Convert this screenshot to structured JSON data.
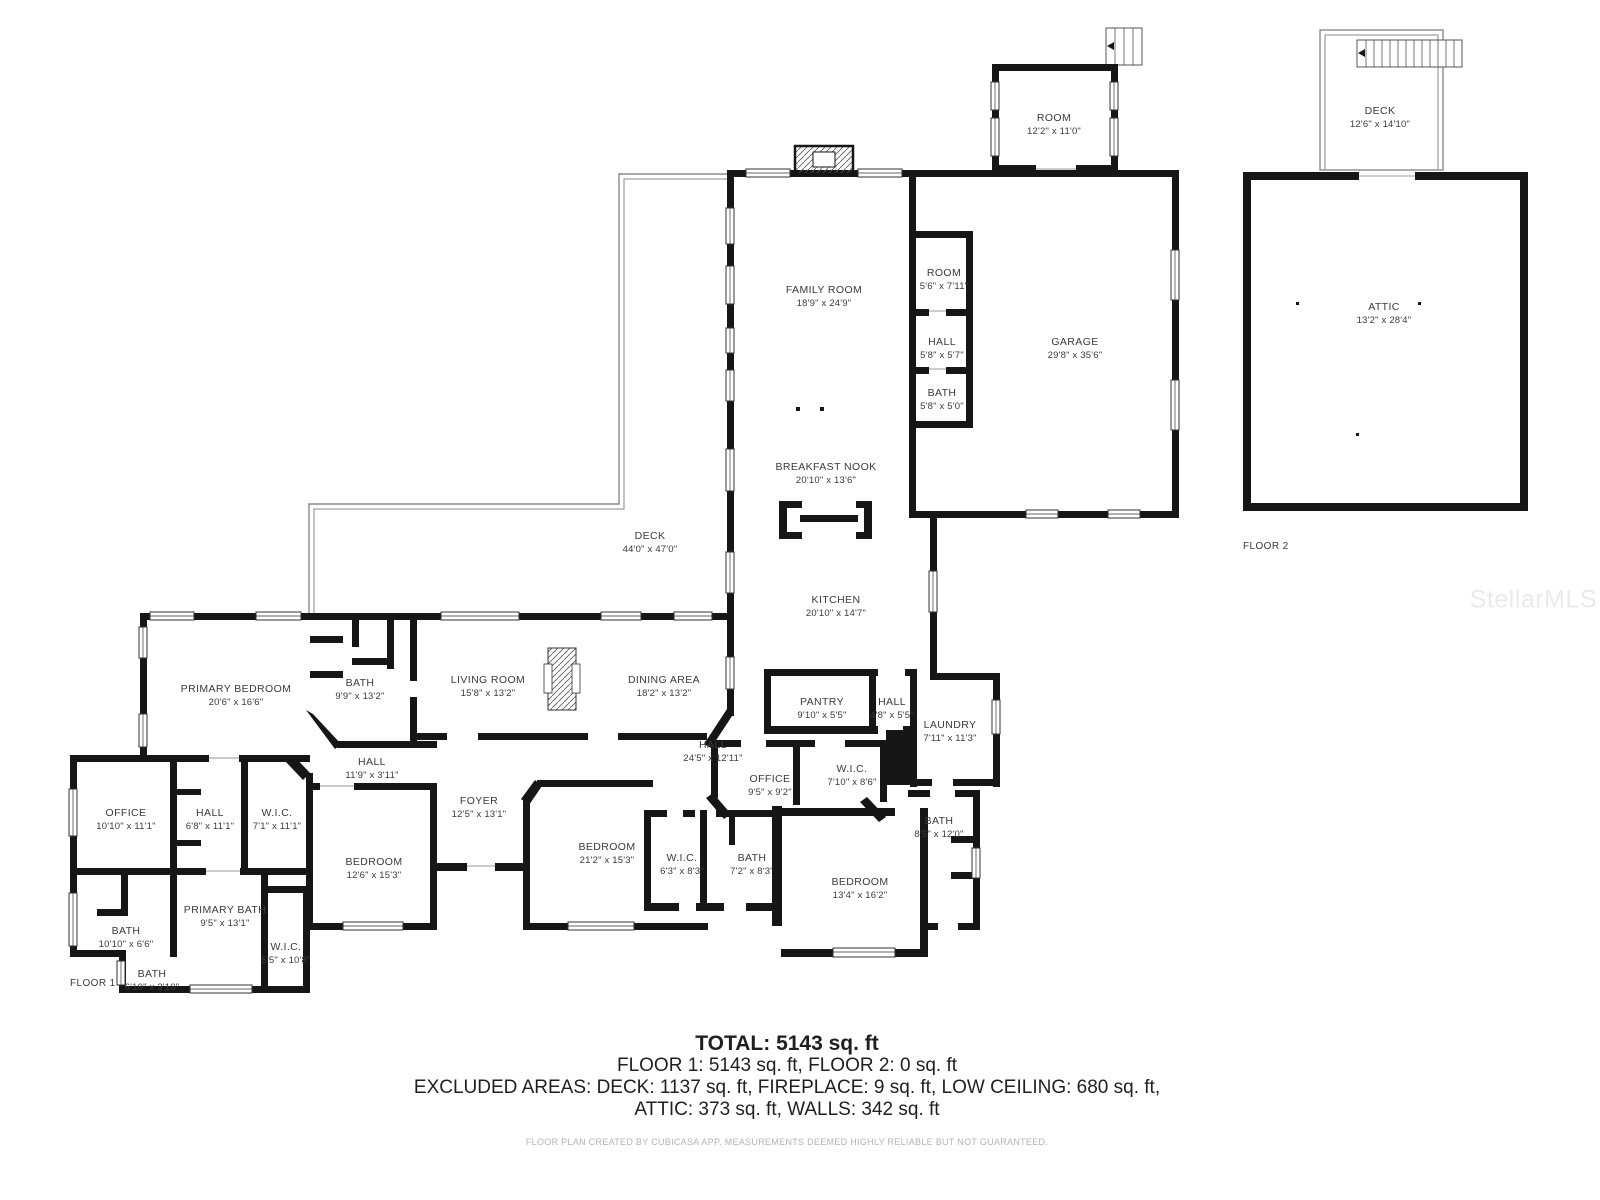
{
  "watermark": "StellarMLS",
  "floor_labels": {
    "floor1": "FLOOR 1",
    "floor2": "FLOOR 2"
  },
  "summary": {
    "total": "TOTAL: 5143 sq. ft",
    "floors": "FLOOR 1: 5143 sq. ft, FLOOR 2: 0 sq. ft",
    "excluded1": "EXCLUDED AREAS: DECK: 1137 sq. ft, FIREPLACE: 9 sq. ft, LOW CEILING: 680 sq. ft,",
    "excluded2": "ATTIC: 373 sq. ft, WALLS: 342 sq. ft",
    "credit": "FLOOR PLAN CREATED BY CUBICASA APP. MEASUREMENTS DEEMED HIGHLY RELIABLE BUT NOT GUARANTEED."
  },
  "colors": {
    "walls": "#161616",
    "room_text": "#3a3a3a",
    "credit_text": "#b3b3b3"
  },
  "rooms": [
    {
      "id": "room-upper",
      "name": "ROOM",
      "dims": "12'2\" x 11'0\""
    },
    {
      "id": "deck-upper",
      "name": "DECK",
      "dims": "12'6\" x 14'10\""
    },
    {
      "id": "family-room",
      "name": "FAMILY ROOM",
      "dims": "18'9\" x 24'9\""
    },
    {
      "id": "room-small",
      "name": "ROOM",
      "dims": "5'6\" x 7'11\""
    },
    {
      "id": "hall-small",
      "name": "HALL",
      "dims": "5'8\" x 5'7\""
    },
    {
      "id": "bath-small",
      "name": "BATH",
      "dims": "5'8\" x 5'0\""
    },
    {
      "id": "garage",
      "name": "GARAGE",
      "dims": "29'8\" x 35'6\""
    },
    {
      "id": "attic",
      "name": "ATTIC",
      "dims": "13'2\" x 28'4\""
    },
    {
      "id": "breakfast-nook",
      "name": "BREAKFAST NOOK",
      "dims": "20'10\" x 13'6\""
    },
    {
      "id": "deck-main",
      "name": "DECK",
      "dims": "44'0\" x 47'0\""
    },
    {
      "id": "kitchen",
      "name": "KITCHEN",
      "dims": "20'10\" x 14'7\""
    },
    {
      "id": "primary-bedroom",
      "name": "PRIMARY BEDROOM",
      "dims": "20'6\" x 16'6\""
    },
    {
      "id": "bath-9-9",
      "name": "BATH",
      "dims": "9'9\" x 13'2\""
    },
    {
      "id": "living-room",
      "name": "LIVING ROOM",
      "dims": "15'8\" x 13'2\""
    },
    {
      "id": "dining-area",
      "name": "DINING AREA",
      "dims": "18'2\" x 13'2\""
    },
    {
      "id": "pantry",
      "name": "PANTRY",
      "dims": "9'10\" x 5'5\""
    },
    {
      "id": "hall-4-8",
      "name": "HALL",
      "dims": "4'8\" x 5'5\""
    },
    {
      "id": "laundry",
      "name": "LAUNDRY",
      "dims": "7'11\" x 11'3\""
    },
    {
      "id": "hall-24-5",
      "name": "HALL",
      "dims": "24'5\" x 12'11\""
    },
    {
      "id": "hall-11-9",
      "name": "HALL",
      "dims": "11'9\" x 3'11\""
    },
    {
      "id": "office-9-5",
      "name": "OFFICE",
      "dims": "9'5\" x 9'2\""
    },
    {
      "id": "wic-7-10",
      "name": "W.I.C.",
      "dims": "7'10\" x 8'6\""
    },
    {
      "id": "office-10-10",
      "name": "OFFICE",
      "dims": "10'10\" x 11'1\""
    },
    {
      "id": "hall-6-8",
      "name": "HALL",
      "dims": "6'8\" x 11'1\""
    },
    {
      "id": "wic-7-1",
      "name": "W.I.C.",
      "dims": "7'1\" x 11'1\""
    },
    {
      "id": "foyer",
      "name": "FOYER",
      "dims": "12'5\" x 13'1\""
    },
    {
      "id": "bath-8-5",
      "name": "BATH",
      "dims": "8'5\" x 12'0\""
    },
    {
      "id": "bedroom-12-6",
      "name": "BEDROOM",
      "dims": "12'6\" x 15'3\""
    },
    {
      "id": "bedroom-21-2",
      "name": "BEDROOM",
      "dims": "21'2\" x 15'3\""
    },
    {
      "id": "wic-6-3",
      "name": "W.I.C.",
      "dims": "6'3\" x 8'3\""
    },
    {
      "id": "bath-7-2",
      "name": "BATH",
      "dims": "7'2\" x 8'3\""
    },
    {
      "id": "bedroom-13-4",
      "name": "BEDROOM",
      "dims": "13'4\" x 16'2\""
    },
    {
      "id": "bath-10-10",
      "name": "BATH",
      "dims": "10'10\" x 6'6\""
    },
    {
      "id": "primary-bath",
      "name": "PRIMARY BATH",
      "dims": "9'5\" x 13'1\""
    },
    {
      "id": "wic-5-5",
      "name": "W.I.C.",
      "dims": "5'5\" x 10'8\""
    },
    {
      "id": "bath-6-10",
      "name": "BATH",
      "dims": "6'10\" x 3'10\""
    }
  ]
}
